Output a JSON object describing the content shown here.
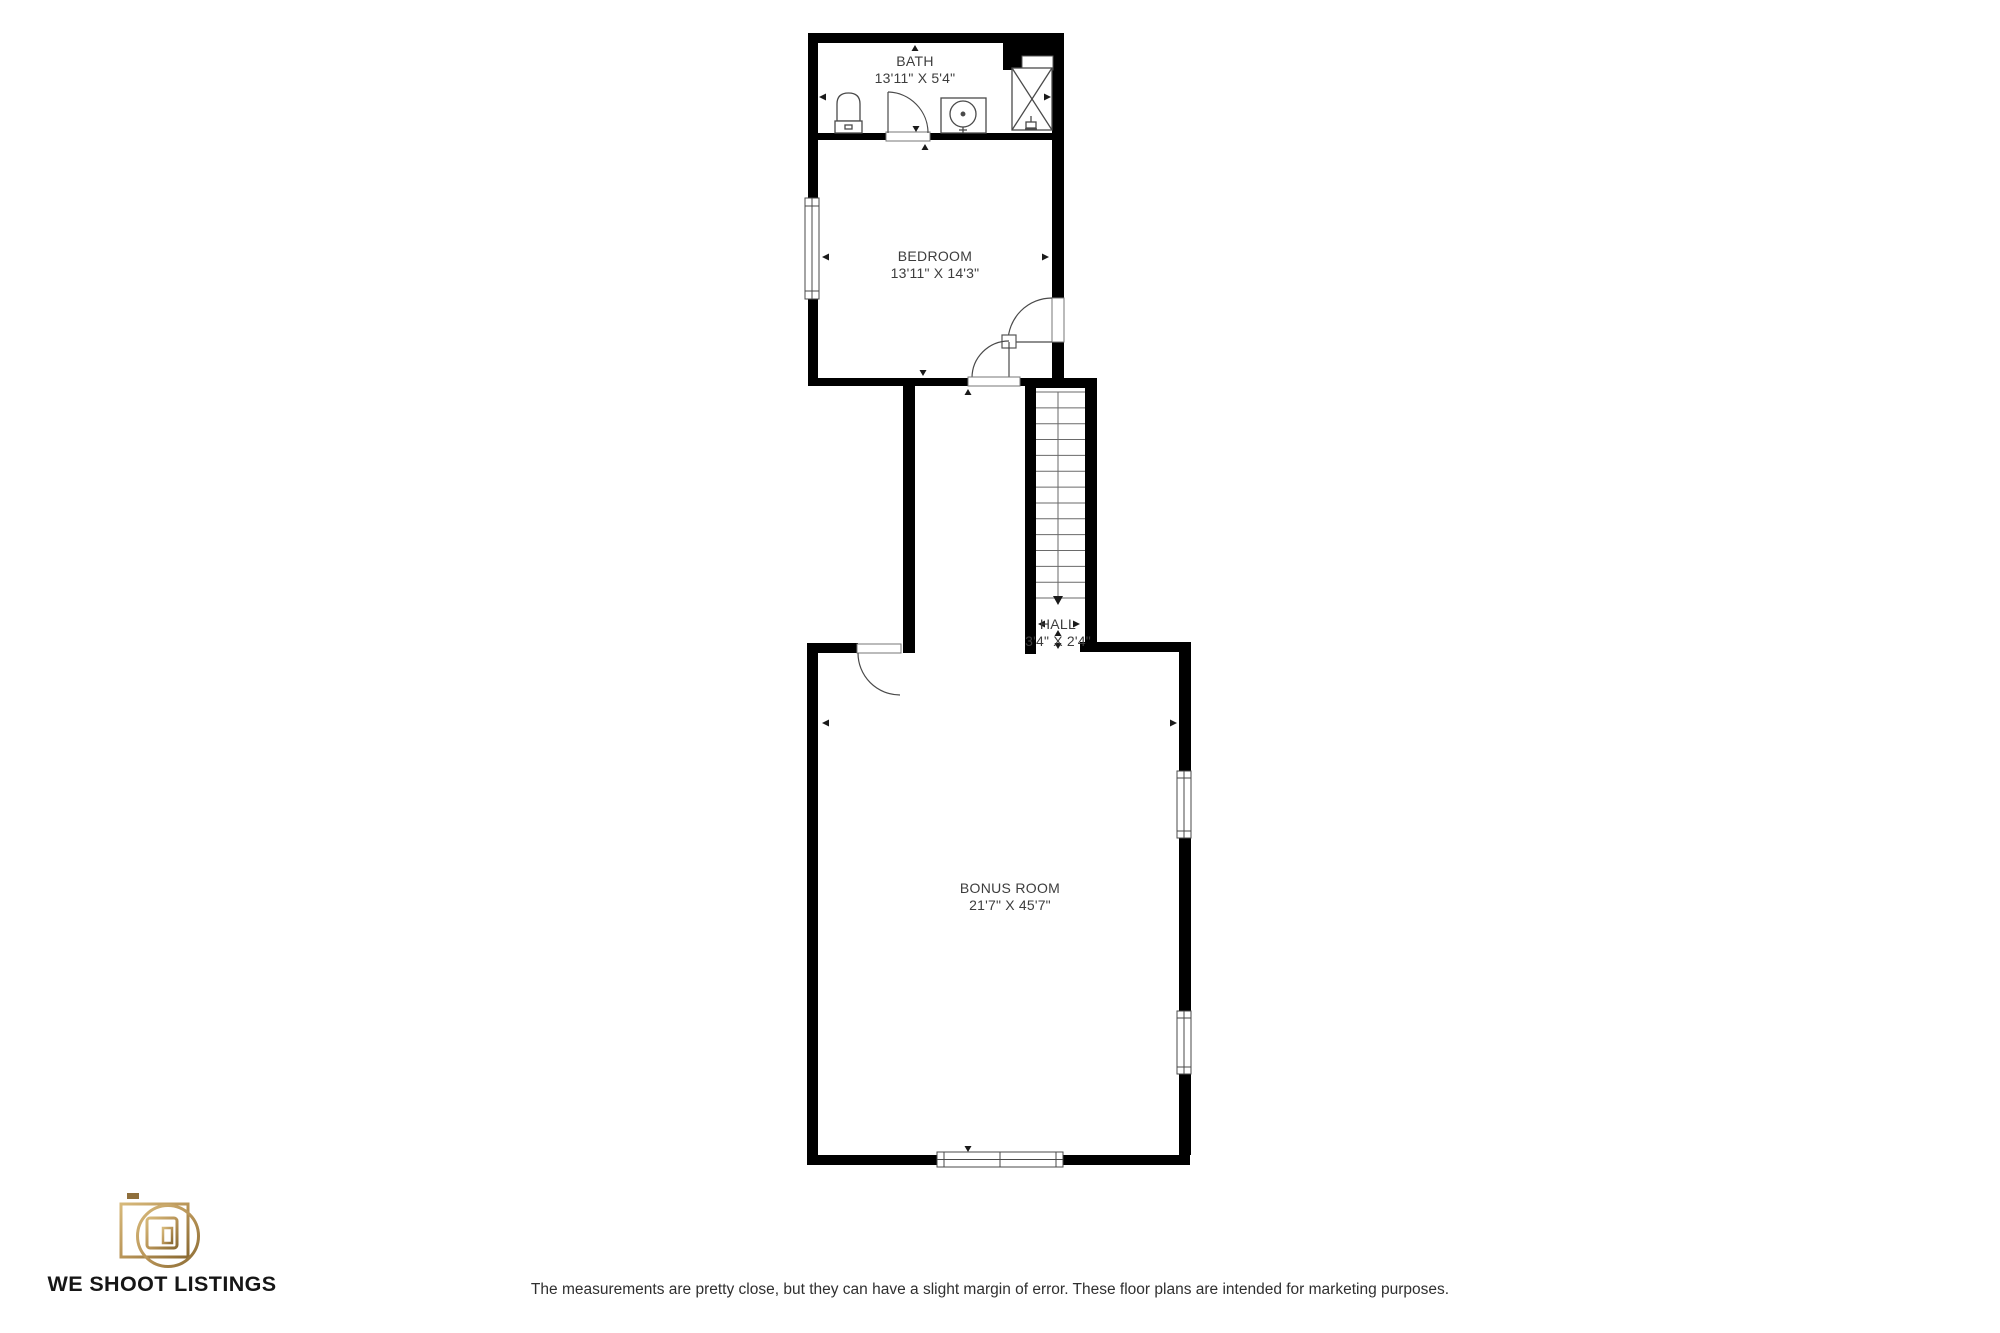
{
  "floorplan": {
    "rooms": [
      {
        "name": "BATH",
        "dims": "13'11\" X 5'4\""
      },
      {
        "name": "BEDROOM",
        "dims": "13'11\" X 14'3\""
      },
      {
        "name": "HALL",
        "dims": "3'4\" X 2'4\""
      },
      {
        "name": "BONUS ROOM",
        "dims": "21'7\" X 45'7\""
      }
    ],
    "stair_direction": "down"
  },
  "branding": {
    "logo_text": "WE SHOOT LISTINGS",
    "logo_icon": "camera-icon"
  },
  "footer": {
    "disclaimer": "The measurements are pretty close, but they can have a slight margin of error. These floor plans are intended for marketing purposes."
  },
  "colors": {
    "wall": "#000000",
    "line": "#4a4a4a",
    "label": "#3d3d3d",
    "gold_light": "#d7b97b",
    "gold_dark": "#8a6a33",
    "logo_text": "#161616"
  }
}
